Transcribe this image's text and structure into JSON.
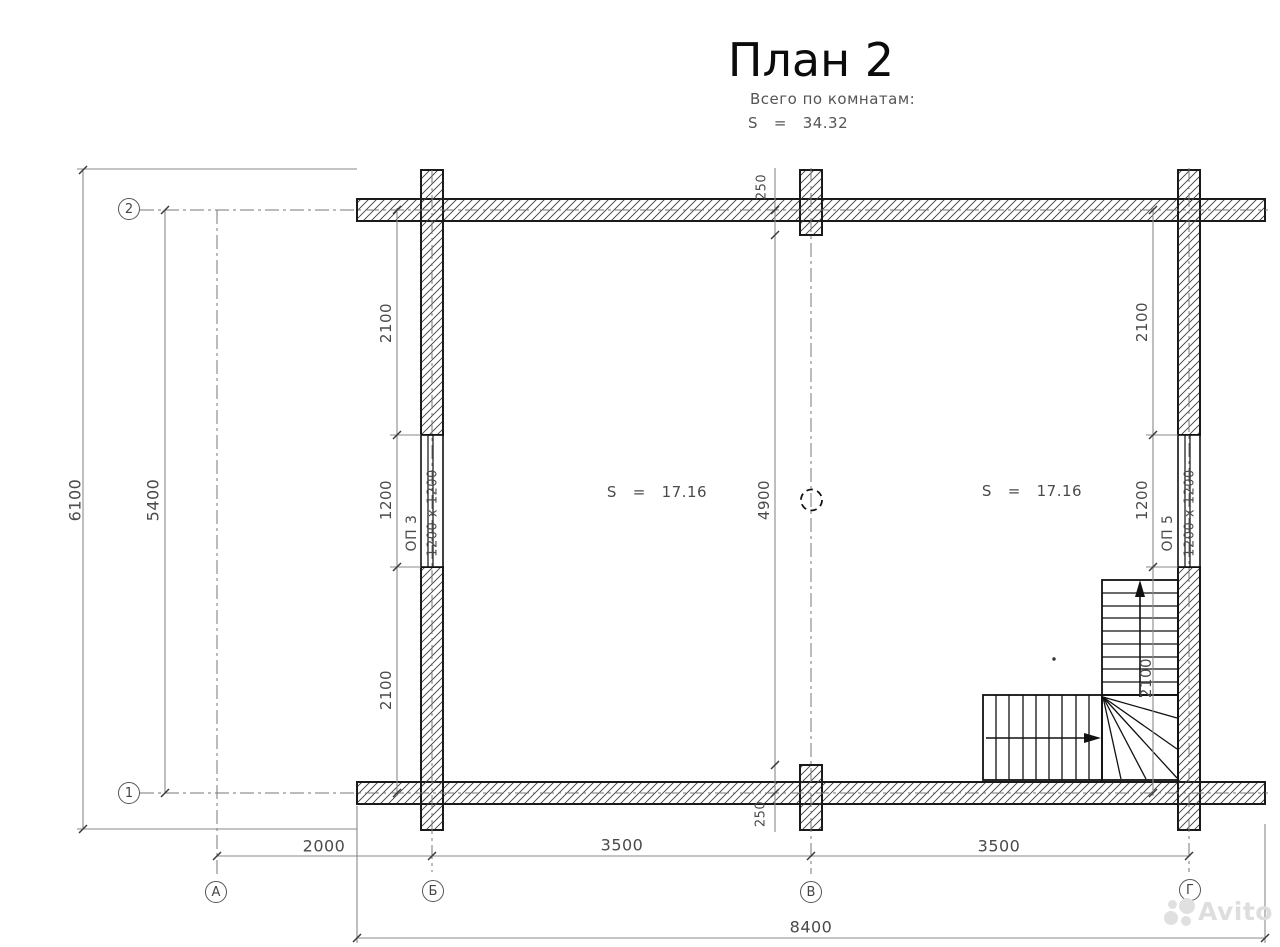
{
  "title": "План 2",
  "summary": {
    "caption": "Всего по комнатам:",
    "total": "S   =   34.32"
  },
  "rooms": {
    "left_area": "S   =   17.16",
    "right_area": "S   =   17.16"
  },
  "windows": {
    "left_label": "ОП 3",
    "left_size": "1200 x 1200",
    "right_label": "ОП 5",
    "right_size": "1200 x 1200"
  },
  "dims": {
    "outer_height": "6100",
    "axis_height": "5400",
    "left_chain": [
      "2100",
      "1200",
      "2100"
    ],
    "center_chain": [
      "250",
      "4900",
      "250"
    ],
    "right_chain": [
      "2100",
      "1200",
      "2100"
    ],
    "bottom_chain": [
      "2000",
      "3500",
      "3500"
    ],
    "outer_width": "8400"
  },
  "axes": {
    "row_top": "2",
    "row_bottom": "1",
    "col_a": "А",
    "col_b": "Б",
    "col_v": "В",
    "col_g": "Г"
  },
  "watermark": "Avito",
  "colors": {
    "wall_line": "#1a1a1a",
    "dim_line": "#8a8a8a",
    "axis_line": "#777777",
    "text": "#4a4a4a",
    "watermark": "#dedede"
  }
}
